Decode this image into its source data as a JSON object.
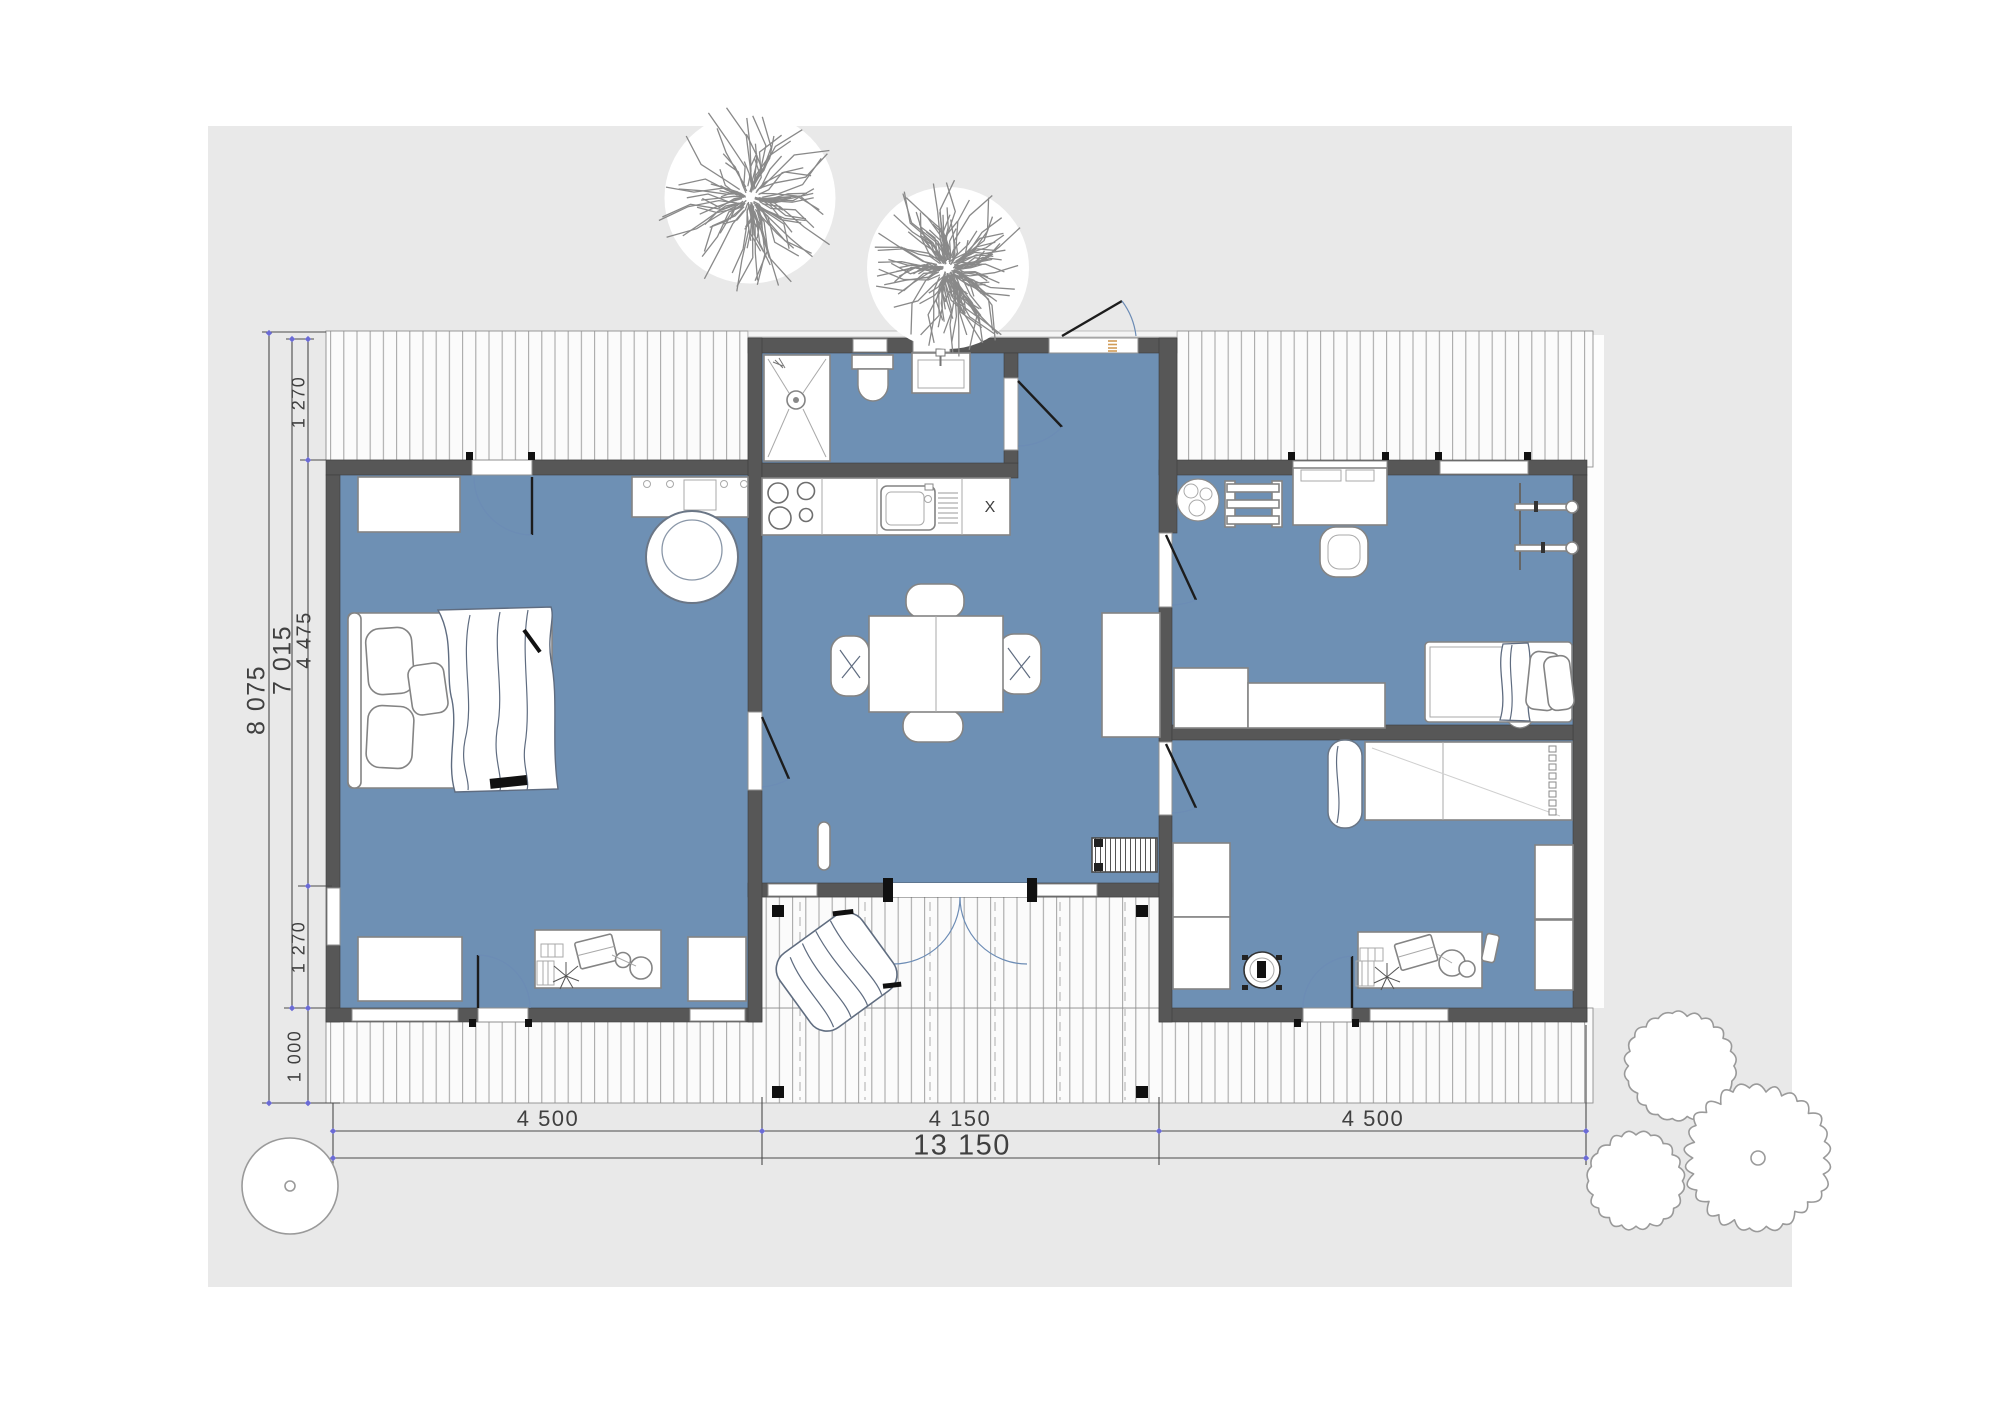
{
  "plan": {
    "annotations": {
      "kitchen_mark": "X"
    },
    "dimensions": {
      "left": {
        "overall": "8 075",
        "shell": "7 015",
        "segments": [
          "1 270",
          "4 475",
          "1 270",
          "1 000"
        ]
      },
      "bottom": {
        "segments": [
          "4 500",
          "4 150",
          "4 500"
        ],
        "overall": "13 150"
      }
    },
    "colors": {
      "floor": "#6E90B4",
      "wall": "#575757",
      "site": "#E9E9E9",
      "deck": "#FBFBFB",
      "deck_line": "#A8A8A8",
      "dimension_line": "#4A4A4A",
      "tick": "#6B6BD6",
      "door_arc": "#6C8CB5",
      "front_door_accent": "#D09B57",
      "sketch": "#8A8A8A"
    }
  }
}
